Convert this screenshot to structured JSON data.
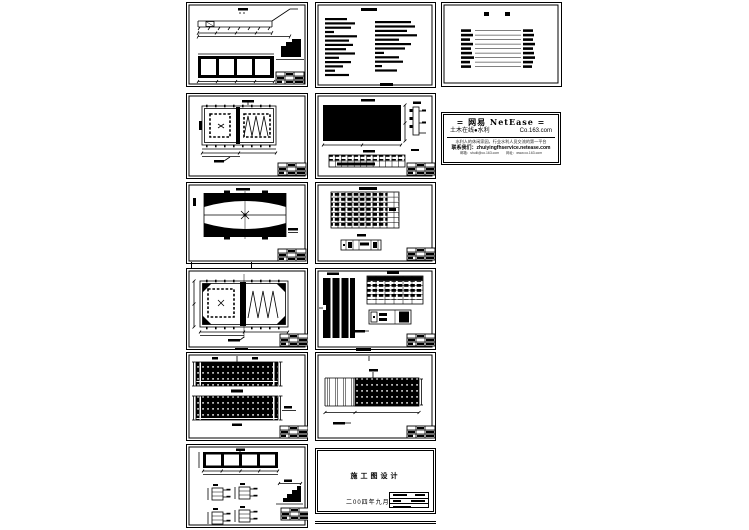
{
  "canvas": {
    "background": "#ffffff",
    "ink": "#000000"
  },
  "netease_stamp": {
    "title": "=  网易  NetEase  =",
    "channel": "土木在线●水利",
    "domain": "Co.163.com",
    "slogan": "水利人的休闲家园，行业水利人员交流的第一平台",
    "contact": "联系我们：zhuiyingfhservice.netease.com",
    "footer": "邮箱：shuili@co.163.com　　网址：www.co.163.com"
  },
  "cover_sheet": {
    "title": "施工图设计",
    "date": "二00四年九月"
  }
}
